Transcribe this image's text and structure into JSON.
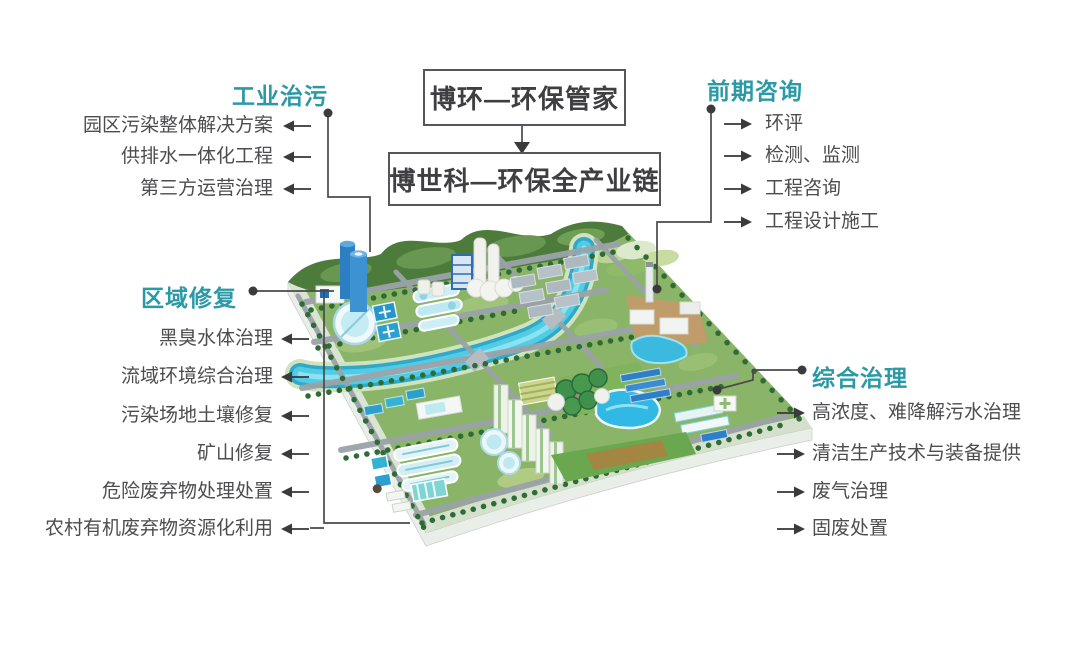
{
  "canvas": {
    "width": 1080,
    "height": 647,
    "background": "#ffffff"
  },
  "palette": {
    "accent_teal": "#2B9AA6",
    "item_text": "#4D4D4F",
    "connector_gray": "#4A4A4C",
    "box_border": "#55565A",
    "box_text": "#3F3F41",
    "river_turquoise": "#3FC3E3",
    "terrain_green": "#8AB468",
    "pool_teal": "#35B1D4",
    "tank_blue": "#2B7FC2"
  },
  "icons": {
    "arrow_left": "←",
    "arrow_right": "→",
    "arrow_down": "↓",
    "connector_dot": "●"
  },
  "flow": {
    "top_box": "博环—环保管家",
    "bottom_box": "博世科—环保全产业链"
  },
  "groups": {
    "industrial": {
      "title": "工业治污",
      "items": [
        "园区污染整体解决方案",
        "供排水一体化工程",
        "第三方运营治理"
      ]
    },
    "consulting": {
      "title": "前期咨询",
      "items": [
        "环评",
        "检测、监测",
        "工程咨询",
        "工程设计施工"
      ]
    },
    "remediation": {
      "title": "区域修复",
      "items": [
        "黑臭水体治理",
        "流域环境综合治理",
        "污染场地土壤修复",
        "矿山修复",
        "危险废弃物处理处置",
        "农村有机废弃物资源化利用"
      ]
    },
    "comprehensive": {
      "title": "综合治理",
      "items": [
        "高浓度、难降解污水治理",
        "清洁生产技术与装备提供",
        "废气治理",
        "固废处置"
      ]
    }
  },
  "illustration": {
    "type": "isometric-eco-industrial-park",
    "features": [
      "hills",
      "terraced-fields",
      "river",
      "bridges",
      "roads",
      "trees",
      "water-treatment-plant",
      "clarifier-tanks",
      "treatment-pools",
      "blue-storage-tanks",
      "chemical-plant",
      "factory-sheds",
      "industrial-zone-with-chimney",
      "pond",
      "residential-towers",
      "park-lake",
      "swimming-pool",
      "digester-tanks",
      "solar-panels",
      "oxidation-ditches",
      "sports-field",
      "greenhouse-buildings"
    ]
  }
}
